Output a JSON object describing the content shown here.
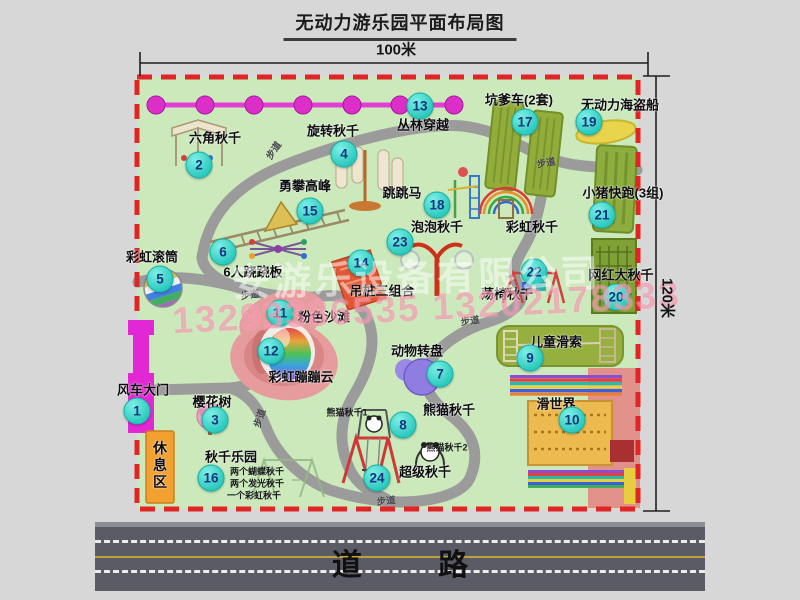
{
  "title": "无动力游乐园平面布局图",
  "dimensions": {
    "width": "100米",
    "height": "120米"
  },
  "road": {
    "name": "道 路"
  },
  "watermark": {
    "company": "安游乐设备有限公司",
    "phones": "13293386535 13202178333"
  },
  "colors": {
    "boundary": "#e12525",
    "park": "#cbe9bb",
    "path": "#9b9b9b",
    "badge": "#2cc9be",
    "badge_text": "#16357f",
    "zipline": "#e13fd4",
    "gate": "#e128d4",
    "rest_area": "#f2a02f",
    "road": "#5b5b66"
  },
  "icons": {
    "zipline": "magenta-line-with-dots",
    "pirate-ship": "yellow-ellipse",
    "pink-beach": "pink-blob",
    "bounce-cloud": "rainbow-blob",
    "animal-carousel": "purple-circle",
    "rainbow-swing": "rainbow-arcs",
    "slide-world": "rainbow-stripes-block",
    "windmill-gate": "magenta-bar",
    "rest-area": "orange-box"
  },
  "attractions": [
    {
      "num": "1",
      "label": "风车大门",
      "badge": {
        "x": 137,
        "y": 411
      },
      "label_pos": {
        "x": 143,
        "y": 389
      }
    },
    {
      "num": "2",
      "label": "六角秋千",
      "badge": {
        "x": 199,
        "y": 165
      },
      "label_pos": {
        "x": 215,
        "y": 137
      }
    },
    {
      "num": "3",
      "label": "樱花树",
      "badge": {
        "x": 215,
        "y": 420
      },
      "label_pos": {
        "x": 212,
        "y": 401
      }
    },
    {
      "num": "4",
      "label": "旋转秋千",
      "badge": {
        "x": 344,
        "y": 154
      },
      "label_pos": {
        "x": 333,
        "y": 130
      }
    },
    {
      "num": "5",
      "label": "彩虹滚筒",
      "badge": {
        "x": 160,
        "y": 279
      },
      "label_pos": {
        "x": 152,
        "y": 256
      }
    },
    {
      "num": "6",
      "label": "6人跷跷板",
      "badge": {
        "x": 223,
        "y": 252
      },
      "label_pos": {
        "x": 253,
        "y": 271
      }
    },
    {
      "num": "7",
      "label": "动物转盘",
      "badge": {
        "x": 440,
        "y": 374
      },
      "label_pos": {
        "x": 417,
        "y": 350
      }
    },
    {
      "num": "8",
      "label": "熊猫秋千",
      "badge": {
        "x": 403,
        "y": 425
      },
      "label_pos": {
        "x": 449,
        "y": 409
      }
    },
    {
      "num": "9",
      "label": "儿童滑索",
      "badge": {
        "x": 530,
        "y": 358
      },
      "label_pos": {
        "x": 556,
        "y": 341
      }
    },
    {
      "num": "10",
      "label": "滑世界",
      "badge": {
        "x": 572,
        "y": 420
      },
      "label_pos": {
        "x": 556,
        "y": 403
      }
    },
    {
      "num": "11",
      "label": "粉色沙滩",
      "badge": {
        "x": 280,
        "y": 313
      },
      "label_pos": {
        "x": 324,
        "y": 316
      }
    },
    {
      "num": "12",
      "label": "彩虹蹦蹦云",
      "badge": {
        "x": 271,
        "y": 351
      },
      "label_pos": {
        "x": 301,
        "y": 376
      }
    },
    {
      "num": "13",
      "label": "丛林穿越",
      "badge": {
        "x": 420,
        "y": 106
      },
      "label_pos": {
        "x": 423,
        "y": 124
      }
    },
    {
      "num": "14",
      "label": "吊桩三组合",
      "badge": {
        "x": 361,
        "y": 263
      },
      "label_pos": {
        "x": 382,
        "y": 290
      }
    },
    {
      "num": "15",
      "label": "勇攀高峰",
      "badge": {
        "x": 310,
        "y": 211
      },
      "label_pos": {
        "x": 305,
        "y": 185
      }
    },
    {
      "num": "16",
      "label": "秋千乐园",
      "badge": {
        "x": 211,
        "y": 478
      },
      "label_pos": {
        "x": 231,
        "y": 456
      }
    },
    {
      "num": "17",
      "label": "坑爹车(2套)",
      "badge": {
        "x": 525,
        "y": 122
      },
      "label_pos": {
        "x": 519,
        "y": 99
      }
    },
    {
      "num": "18",
      "label": "跳跳马",
      "badge": {
        "x": 437,
        "y": 205
      },
      "label_pos": {
        "x": 402,
        "y": 192
      }
    },
    {
      "num": "19",
      "label": "无动力海盗船",
      "badge": {
        "x": 589,
        "y": 122
      },
      "label_pos": {
        "x": 620,
        "y": 104
      }
    },
    {
      "num": "20",
      "label": "网红大秋千",
      "badge": {
        "x": 616,
        "y": 297
      },
      "label_pos": {
        "x": 621,
        "y": 274
      }
    },
    {
      "num": "21",
      "label": "小猪快跑(3组)",
      "badge": {
        "x": 602,
        "y": 215
      },
      "label_pos": {
        "x": 623,
        "y": 192
      }
    },
    {
      "num": "22",
      "label": "荡椅秋千",
      "badge": {
        "x": 534,
        "y": 272
      },
      "label_pos": {
        "x": 507,
        "y": 293
      }
    },
    {
      "num": "23",
      "label": "泡泡秋千",
      "badge": {
        "x": 400,
        "y": 242
      },
      "label_pos": {
        "x": 437,
        "y": 226
      }
    },
    {
      "num": "24",
      "label": "超级秋千",
      "badge": {
        "x": 377,
        "y": 478
      },
      "label_pos": {
        "x": 425,
        "y": 471
      }
    }
  ],
  "unnumbered_labels": [
    {
      "label": "彩虹秋千",
      "x": 532,
      "y": 226,
      "vertical": false
    },
    {
      "label": "休息区",
      "x": 160,
      "y": 466,
      "vertical": true
    }
  ],
  "sub_labels": [
    {
      "label": "熊猫秋千1",
      "x": 347,
      "y": 412
    },
    {
      "label": "熊猫秋千2",
      "x": 447,
      "y": 447
    },
    {
      "label": "两个蝴蝶秋千",
      "x": 257,
      "y": 471
    },
    {
      "label": "两个发光秋千",
      "x": 257,
      "y": 483
    },
    {
      "label": "一个彩虹秋千",
      "x": 254,
      "y": 495
    }
  ],
  "path_markers": [
    {
      "label": "步道",
      "x": 273,
      "y": 150,
      "rot": -55
    },
    {
      "label": "步道",
      "x": 546,
      "y": 162,
      "rot": -10
    },
    {
      "label": "步道",
      "x": 250,
      "y": 294,
      "rot": -8
    },
    {
      "label": "步道",
      "x": 470,
      "y": 320,
      "rot": -8
    },
    {
      "label": "步道",
      "x": 259,
      "y": 418,
      "rot": -72
    },
    {
      "label": "步道",
      "x": 386,
      "y": 500,
      "rot": -5
    }
  ]
}
